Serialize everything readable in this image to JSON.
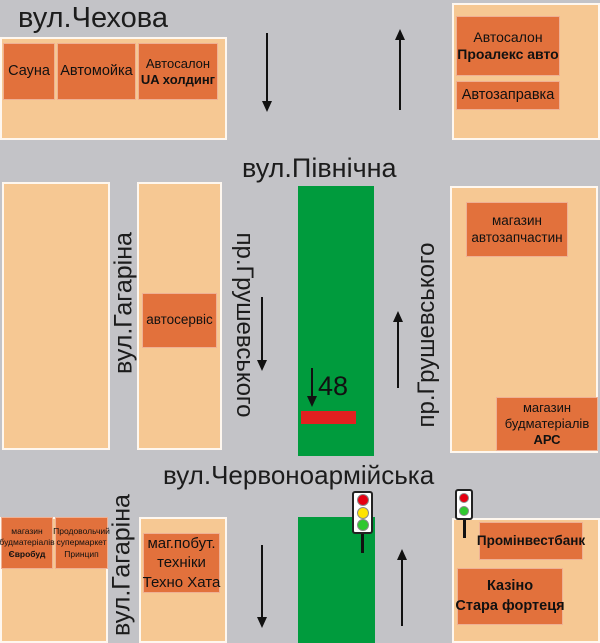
{
  "colors": {
    "background": "#c3c3c7",
    "block": "#f6c893",
    "building": "#e2713c",
    "median": "#009b3d",
    "billboard": "#e32020",
    "light_red": "#e60012",
    "light_yellow": "#ffe400",
    "light_green": "#2fc82f"
  },
  "streets": {
    "chekhova": "вул.Чехова",
    "pivnichna": "вул.Північна",
    "chervonoarmiiska": "вул.Червоноармійська",
    "hrushevskoho": "пр.Грушевського",
    "haharina": "вул.Гагаріна"
  },
  "billboard": {
    "number": "48"
  },
  "buildings": {
    "sauna": {
      "lines": [
        "Сауна"
      ]
    },
    "car_wash": {
      "lines": [
        "Автомойка"
      ]
    },
    "ua_holding": {
      "lines": [
        "Автосалон",
        "UA холдинг"
      ]
    },
    "proaleks_avto": {
      "lines": [
        "Автосалон",
        "Проалекс авто"
      ]
    },
    "avtozapravka": {
      "lines": [
        "Автозаправка"
      ]
    },
    "avtoservis": {
      "lines": [
        "автосервіс"
      ]
    },
    "avtozapchastyny": {
      "lines": [
        "магазин",
        "автозапчастин"
      ]
    },
    "ars": {
      "lines": [
        "магазин",
        "будматеріалів",
        "АРС"
      ]
    },
    "yevrobud": {
      "lines": [
        "магазин",
        "будматеріалів",
        "Євробуд"
      ]
    },
    "pryntsyp": {
      "lines": [
        "Продовольчий",
        "супермаркет",
        "Принцип"
      ]
    },
    "tekhno_khata": {
      "lines": [
        "маг.побут.",
        "техніки",
        "Техно Хата"
      ]
    },
    "prominvestbank": {
      "lines": [
        "Промінвестбанк"
      ]
    },
    "kazino": {
      "lines": [
        "Казіно",
        "Стара фортеця"
      ]
    }
  }
}
